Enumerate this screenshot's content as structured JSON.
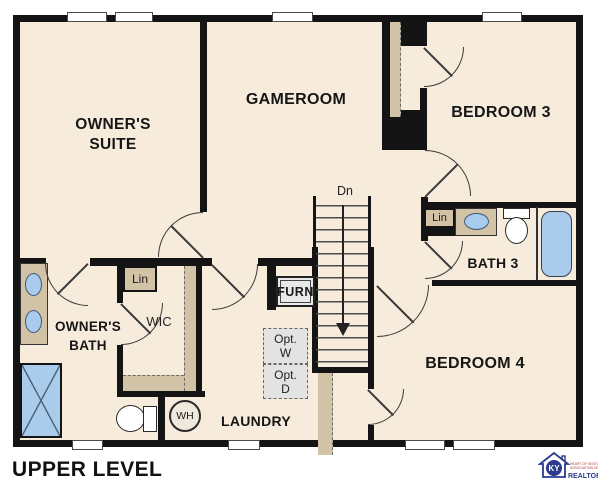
{
  "plan_title": "UPPER LEVEL",
  "labels": {
    "owners_suite_line1": "OWNER'S",
    "owners_suite_line2": "SUITE",
    "gameroom": "GAMEROOM",
    "bedroom3": "BEDROOM 3",
    "bedroom4": "BEDROOM 4",
    "bath3": "BATH 3",
    "owners_bath_line1": "OWNER'S",
    "owners_bath_line2": "BATH",
    "wic": "WIC",
    "laundry": "LAUNDRY",
    "lin_wic": "Lin",
    "lin_bath3": "Lin",
    "stairs_down": "Dn",
    "furnace": "FURN",
    "opt_washer_line1": "Opt.",
    "opt_washer_line2": "W",
    "opt_dryer_line1": "Opt.",
    "opt_dryer_line2": "D",
    "water_heater": "WH"
  },
  "logo": {
    "monogram": "KY",
    "org_line1": "HEART OF KENTUCKY",
    "org_line2": "ASSOCIATION OF",
    "realtors": "REALTORS",
    "registered": "®"
  },
  "colors": {
    "floor": "#f7ecdc",
    "wall": "#141414",
    "casework": "#d2c3a6",
    "fixture_blue": "#a9cbec",
    "logo_blue": "#2b3b8e",
    "logo_red": "#b03a3a"
  }
}
